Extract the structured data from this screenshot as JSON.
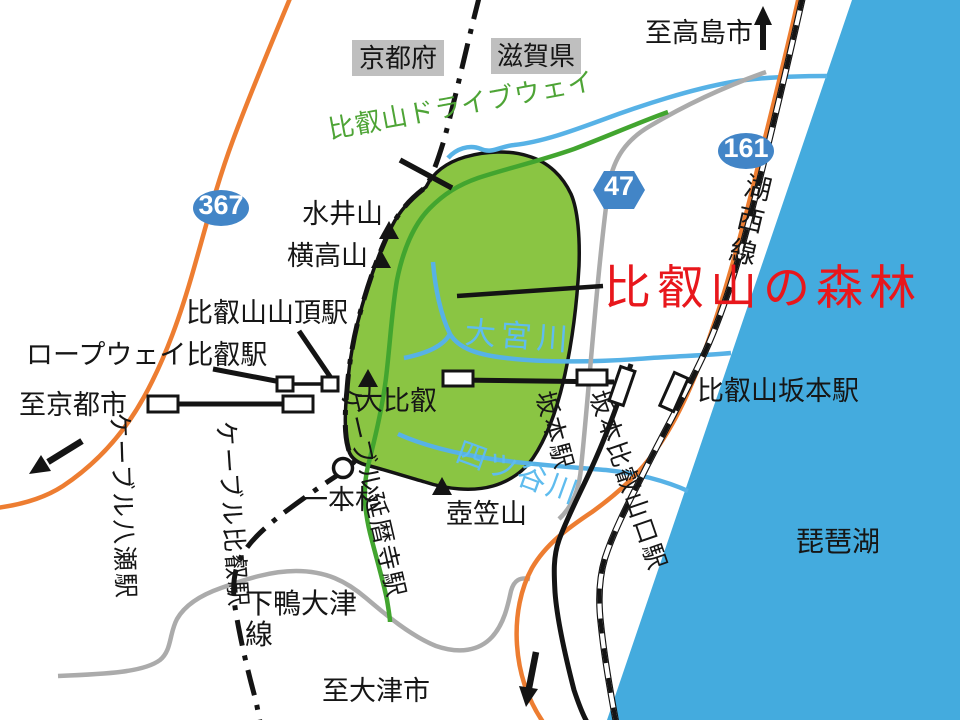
{
  "colors": {
    "lake": "#44ABDE",
    "forest_fill": "#8AC543",
    "river": "#57B2E6",
    "river_text": "#5FBCEE",
    "road_orange": "#ED7D31",
    "road_gray": "#ABABAB",
    "driveway_green": "#42A52F",
    "driveway_text": "#4EA436",
    "route_badge_blue": "#4285C7",
    "forest_label_red": "#E8171C",
    "pref_label_bg": "#BFBFBF",
    "line_black": "#141414"
  },
  "regions": {
    "kyoto_pref": "京都府",
    "shiga_pref": "滋賀県",
    "lake_biwa": "琵琶湖",
    "forest": "比叡山の森林"
  },
  "directions": {
    "to_takashima": "至高島市",
    "to_kyoto": "至京都市",
    "to_otsu": "至大津市"
  },
  "route_badges": {
    "r367": "367",
    "r161": "161",
    "r47": "47"
  },
  "roads": {
    "driveway": "比叡山ドライブウェイ",
    "shimogamo_otsu_line1": "下鴨大津",
    "shimogamo_otsu_line2": "線"
  },
  "railways": {
    "kosei_line": "湖西線"
  },
  "stations": {
    "hieizan_sancho": "比叡山山頂駅",
    "ropeway_hiei": "ロープウェイ比叡駅",
    "cable_yase": "ケーブル八瀬駅",
    "cable_hiei": "ケーブル比叡駅",
    "cable_enryakuji": "ケーブル延暦寺駅",
    "sakamoto": "坂本駅",
    "sakamoto_hieizanguchi": "坂本比叡山口駅",
    "hieizan_sakamoto": "比叡山坂本駅"
  },
  "mountains": {
    "mizuiyama": "水井山",
    "yokotakayama": "横高山",
    "daihiei": "大比叡",
    "tsubokasayama": "壺笠山",
    "ipponsugi": "一本杉"
  },
  "rivers": {
    "omiyagawa": "大宮川",
    "yotsuyagawa": "四ツ谷川"
  }
}
